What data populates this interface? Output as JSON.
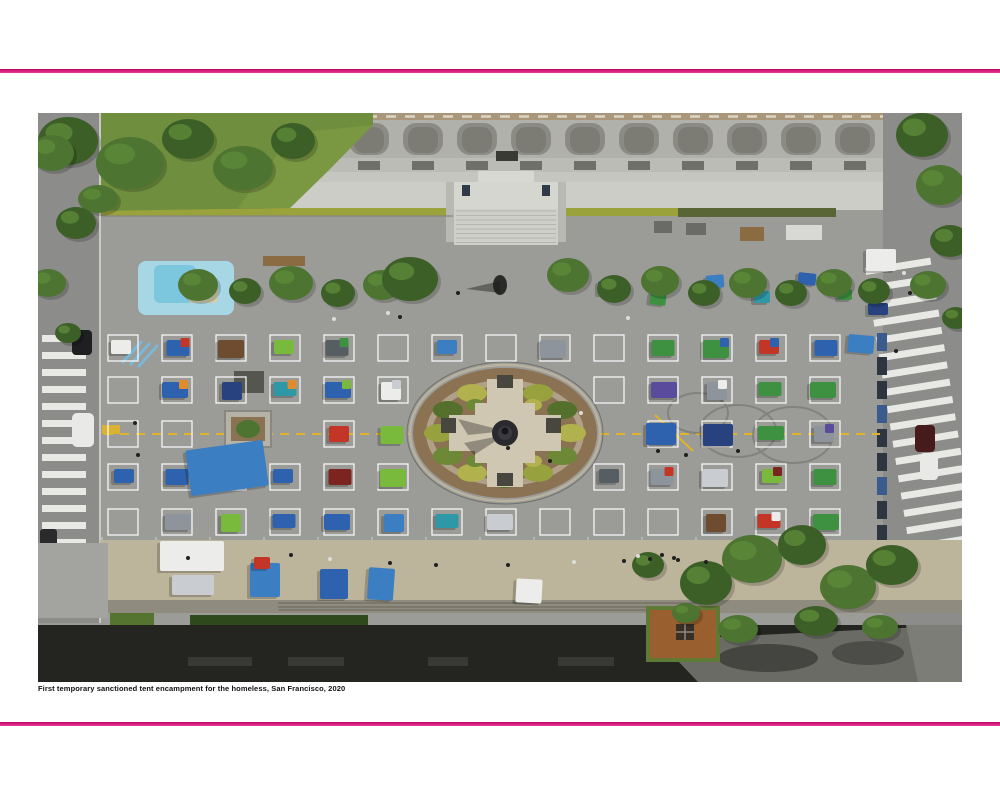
{
  "caption": {
    "text": "First temporary sanctioned tent encampment for the homeless, San Francisco, 2020"
  },
  "accent": {
    "rule_top_color": "#c00368",
    "rule_bottom_color": "#e83e94"
  },
  "figure": {
    "alt": "Aerial view of plaza with physically distanced tent squares",
    "palette": {
      "blue": "#2f62ae",
      "blue2": "#3c7ec2",
      "navy": "#27427e",
      "teal": "#2f98a6",
      "green": "#3f9142",
      "lime": "#79b93c",
      "red": "#c23527",
      "maroon": "#7c2420",
      "orange": "#df8c2e",
      "purple": "#5a4b9c",
      "gray": "#8d949c",
      "darkgray": "#565d63",
      "silver": "#c9cdd1",
      "white": "#ececea",
      "brown": "#6e4c2f"
    },
    "grid": {
      "cols_x": [
        70,
        124,
        178,
        232,
        286,
        340,
        394,
        448,
        502,
        556,
        610,
        664,
        718,
        772
      ],
      "rows_y": [
        222,
        264,
        308,
        351,
        396
      ],
      "cell_w": 30,
      "cell_h": 26,
      "fountain": {
        "cx": 467,
        "cy": 320,
        "rx": 92,
        "ry": 65
      },
      "planter_cells": [
        [
          2,
          2
        ],
        [
          2,
          3
        ]
      ]
    },
    "tents": [
      [
        0,
        0,
        "white"
      ],
      [
        0,
        1,
        "blue",
        "red"
      ],
      [
        0,
        2,
        "brown"
      ],
      [
        0,
        3,
        "lime"
      ],
      [
        0,
        4,
        "darkgray",
        "green"
      ],
      [
        0,
        6,
        "blue2"
      ],
      [
        0,
        8,
        "gray"
      ],
      [
        0,
        10,
        "green"
      ],
      [
        0,
        11,
        "green",
        "blue"
      ],
      [
        0,
        12,
        "red",
        "blue"
      ],
      [
        0,
        13,
        "blue"
      ],
      [
        1,
        1,
        "blue",
        "orange"
      ],
      [
        1,
        2,
        "navy"
      ],
      [
        1,
        3,
        "teal",
        "orange"
      ],
      [
        1,
        4,
        "blue",
        "lime"
      ],
      [
        1,
        5,
        "white",
        "silver"
      ],
      [
        1,
        10,
        "purple"
      ],
      [
        1,
        11,
        "gray",
        "white"
      ],
      [
        1,
        12,
        "green"
      ],
      [
        1,
        13,
        "green"
      ],
      [
        2,
        4,
        "red"
      ],
      [
        2,
        5,
        "lime"
      ],
      [
        2,
        10,
        "blue",
        null,
        1
      ],
      [
        2,
        11,
        "navy",
        null,
        1
      ],
      [
        2,
        12,
        "green"
      ],
      [
        2,
        13,
        "gray",
        "purple"
      ],
      [
        3,
        0,
        "blue"
      ],
      [
        3,
        1,
        "blue"
      ],
      [
        3,
        2,
        "lime"
      ],
      [
        3,
        3,
        "blue"
      ],
      [
        3,
        4,
        "maroon"
      ],
      [
        3,
        5,
        "lime"
      ],
      [
        3,
        9,
        "darkgray"
      ],
      [
        3,
        10,
        "gray",
        "red"
      ],
      [
        3,
        11,
        "silver"
      ],
      [
        3,
        12,
        "lime",
        "maroon"
      ],
      [
        3,
        13,
        "green"
      ],
      [
        4,
        1,
        "gray"
      ],
      [
        4,
        2,
        "lime"
      ],
      [
        4,
        3,
        "blue"
      ],
      [
        4,
        4,
        "blue"
      ],
      [
        4,
        5,
        "blue2"
      ],
      [
        4,
        6,
        "teal"
      ],
      [
        4,
        7,
        "silver"
      ],
      [
        4,
        11,
        "brown"
      ],
      [
        4,
        12,
        "red",
        "white"
      ],
      [
        4,
        13,
        "green"
      ]
    ],
    "free_tents": [
      [
        150,
        332,
        78,
        46,
        "blue2",
        -8
      ],
      [
        560,
        168,
        20,
        14,
        "blue",
        0
      ],
      [
        612,
        180,
        16,
        12,
        "green",
        8
      ],
      [
        668,
        162,
        18,
        13,
        "blue2",
        -5
      ],
      [
        716,
        178,
        16,
        12,
        "teal",
        0
      ],
      [
        760,
        160,
        18,
        12,
        "blue",
        6
      ],
      [
        800,
        176,
        14,
        11,
        "green",
        0
      ],
      [
        810,
        222,
        26,
        18,
        "blue2",
        5
      ],
      [
        122,
        428,
        64,
        30,
        "white",
        0
      ],
      [
        134,
        462,
        42,
        20,
        "silver",
        0
      ],
      [
        212,
        450,
        30,
        34,
        "blue2",
        0
      ],
      [
        216,
        444,
        16,
        12,
        "red",
        0
      ],
      [
        282,
        456,
        28,
        30,
        "blue",
        0
      ],
      [
        330,
        455,
        26,
        32,
        "blue2",
        4
      ],
      [
        478,
        466,
        26,
        24,
        "white",
        3
      ],
      [
        828,
        136,
        30,
        22,
        "white",
        0
      ],
      [
        830,
        190,
        20,
        12,
        "navy",
        0
      ]
    ]
  }
}
